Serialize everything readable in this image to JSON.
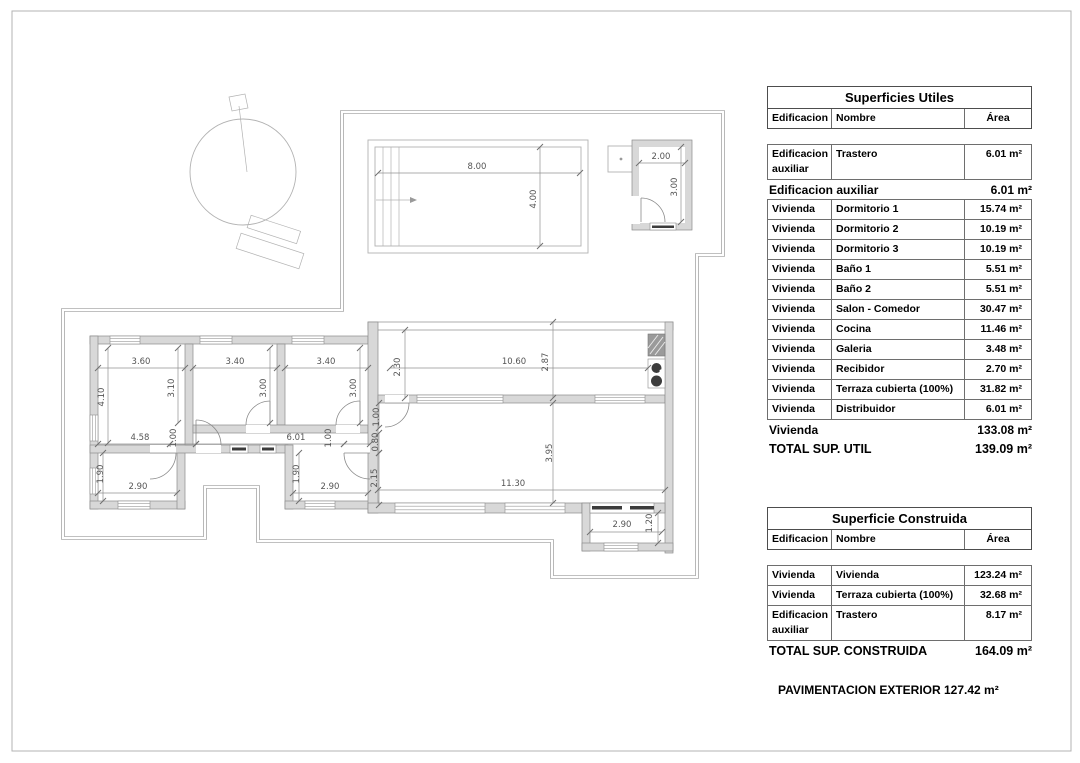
{
  "utiles": {
    "title": "Superficies Utiles",
    "col_edificacion": "Edificacion",
    "col_nombre": "Nombre",
    "col_area": "Área",
    "rows": [
      {
        "e": "Edificacion auxiliar",
        "n": "Trastero",
        "a": "6.01 m²"
      }
    ],
    "sub1_label": "Edificacion auxiliar",
    "sub1_value": "6.01 m²",
    "vrows": [
      {
        "e": "Vivienda",
        "n": "Dormitorio 1",
        "a": "15.74 m²"
      },
      {
        "e": "Vivienda",
        "n": "Dormitorio 2",
        "a": "10.19 m²"
      },
      {
        "e": "Vivienda",
        "n": "Dormitorio 3",
        "a": "10.19 m²"
      },
      {
        "e": "Vivienda",
        "n": "Baño 1",
        "a": "5.51 m²"
      },
      {
        "e": "Vivienda",
        "n": "Baño 2",
        "a": "5.51 m²"
      },
      {
        "e": "Vivienda",
        "n": "Salon - Comedor",
        "a": "30.47 m²"
      },
      {
        "e": "Vivienda",
        "n": "Cocina",
        "a": "11.46 m²"
      },
      {
        "e": "Vivienda",
        "n": "Galeria",
        "a": "3.48 m²"
      },
      {
        "e": "Vivienda",
        "n": "Recibidor",
        "a": "2.70 m²"
      },
      {
        "e": "Vivienda",
        "n": "Terraza cubierta (100%)",
        "a": "31.82 m²"
      },
      {
        "e": "Vivienda",
        "n": "Distribuidor",
        "a": "6.01 m²"
      }
    ],
    "sub2_label": "Vivienda",
    "sub2_value": "133.08 m²",
    "total_label": "TOTAL SUP. UTIL",
    "total_value": "139.09 m²"
  },
  "construida": {
    "title": "Superficie Construida",
    "col_edificacion": "Edificacion",
    "col_nombre": "Nombre",
    "col_area": "Área",
    "rows": [
      {
        "e": "Vivienda",
        "n": "Vivienda",
        "a": "123.24 m²"
      },
      {
        "e": "Vivienda",
        "n": "Terraza cubierta (100%)",
        "a": "32.68 m²"
      },
      {
        "e": "Edificacion auxiliar",
        "n": "Trastero",
        "a": "8.17 m²"
      }
    ],
    "total_label": "TOTAL SUP. CONSTRUIDA",
    "total_value": "164.09 m²"
  },
  "footer": {
    "text": "PAVIMENTACION EXTERIOR 127.42 m²"
  },
  "plan": {
    "dimensions": [
      {
        "t": "8.00",
        "x": 477,
        "y": 169,
        "r": 0
      },
      {
        "t": "4.00",
        "x": 536,
        "y": 199,
        "r": -90
      },
      {
        "t": "2.00",
        "x": 661,
        "y": 159,
        "r": 0
      },
      {
        "t": "3.00",
        "x": 677,
        "y": 187,
        "r": -90
      },
      {
        "t": "3.60",
        "x": 141,
        "y": 364,
        "r": 0
      },
      {
        "t": "3.40",
        "x": 235,
        "y": 364,
        "r": 0
      },
      {
        "t": "3.40",
        "x": 326,
        "y": 364,
        "r": 0
      },
      {
        "t": "4.10",
        "x": 104,
        "y": 397,
        "r": -90
      },
      {
        "t": "3.10",
        "x": 174,
        "y": 388,
        "r": -90
      },
      {
        "t": "3.00",
        "x": 266,
        "y": 388,
        "r": -90
      },
      {
        "t": "3.00",
        "x": 356,
        "y": 388,
        "r": -90
      },
      {
        "t": "2.30",
        "x": 400,
        "y": 367,
        "r": -90
      },
      {
        "t": "10.60",
        "x": 514,
        "y": 364,
        "r": 0
      },
      {
        "t": "2.87",
        "x": 548,
        "y": 362,
        "r": -90
      },
      {
        "t": "4.58",
        "x": 140,
        "y": 440,
        "r": 0
      },
      {
        "t": "1.00",
        "x": 176,
        "y": 438,
        "r": -90
      },
      {
        "t": "6.01",
        "x": 296,
        "y": 440,
        "r": 0
      },
      {
        "t": "1.00",
        "x": 331,
        "y": 438,
        "r": -90
      },
      {
        "t": "1.00",
        "x": 379,
        "y": 417,
        "r": -90
      },
      {
        "t": "0.80",
        "x": 378,
        "y": 442,
        "r": -90
      },
      {
        "t": "2.15",
        "x": 377,
        "y": 478,
        "r": -90
      },
      {
        "t": "1.90",
        "x": 103,
        "y": 474,
        "r": -90
      },
      {
        "t": "2.90",
        "x": 138,
        "y": 489,
        "r": 0
      },
      {
        "t": "1.90",
        "x": 299,
        "y": 474,
        "r": -90
      },
      {
        "t": "2.90",
        "x": 330,
        "y": 489,
        "r": 0
      },
      {
        "t": "3.95",
        "x": 552,
        "y": 453,
        "r": -90
      },
      {
        "t": "11.30",
        "x": 513,
        "y": 486,
        "r": 0
      },
      {
        "t": "2.90",
        "x": 622,
        "y": 527,
        "r": 0
      },
      {
        "t": "1.20",
        "x": 652,
        "y": 523,
        "r": -90
      }
    ]
  }
}
